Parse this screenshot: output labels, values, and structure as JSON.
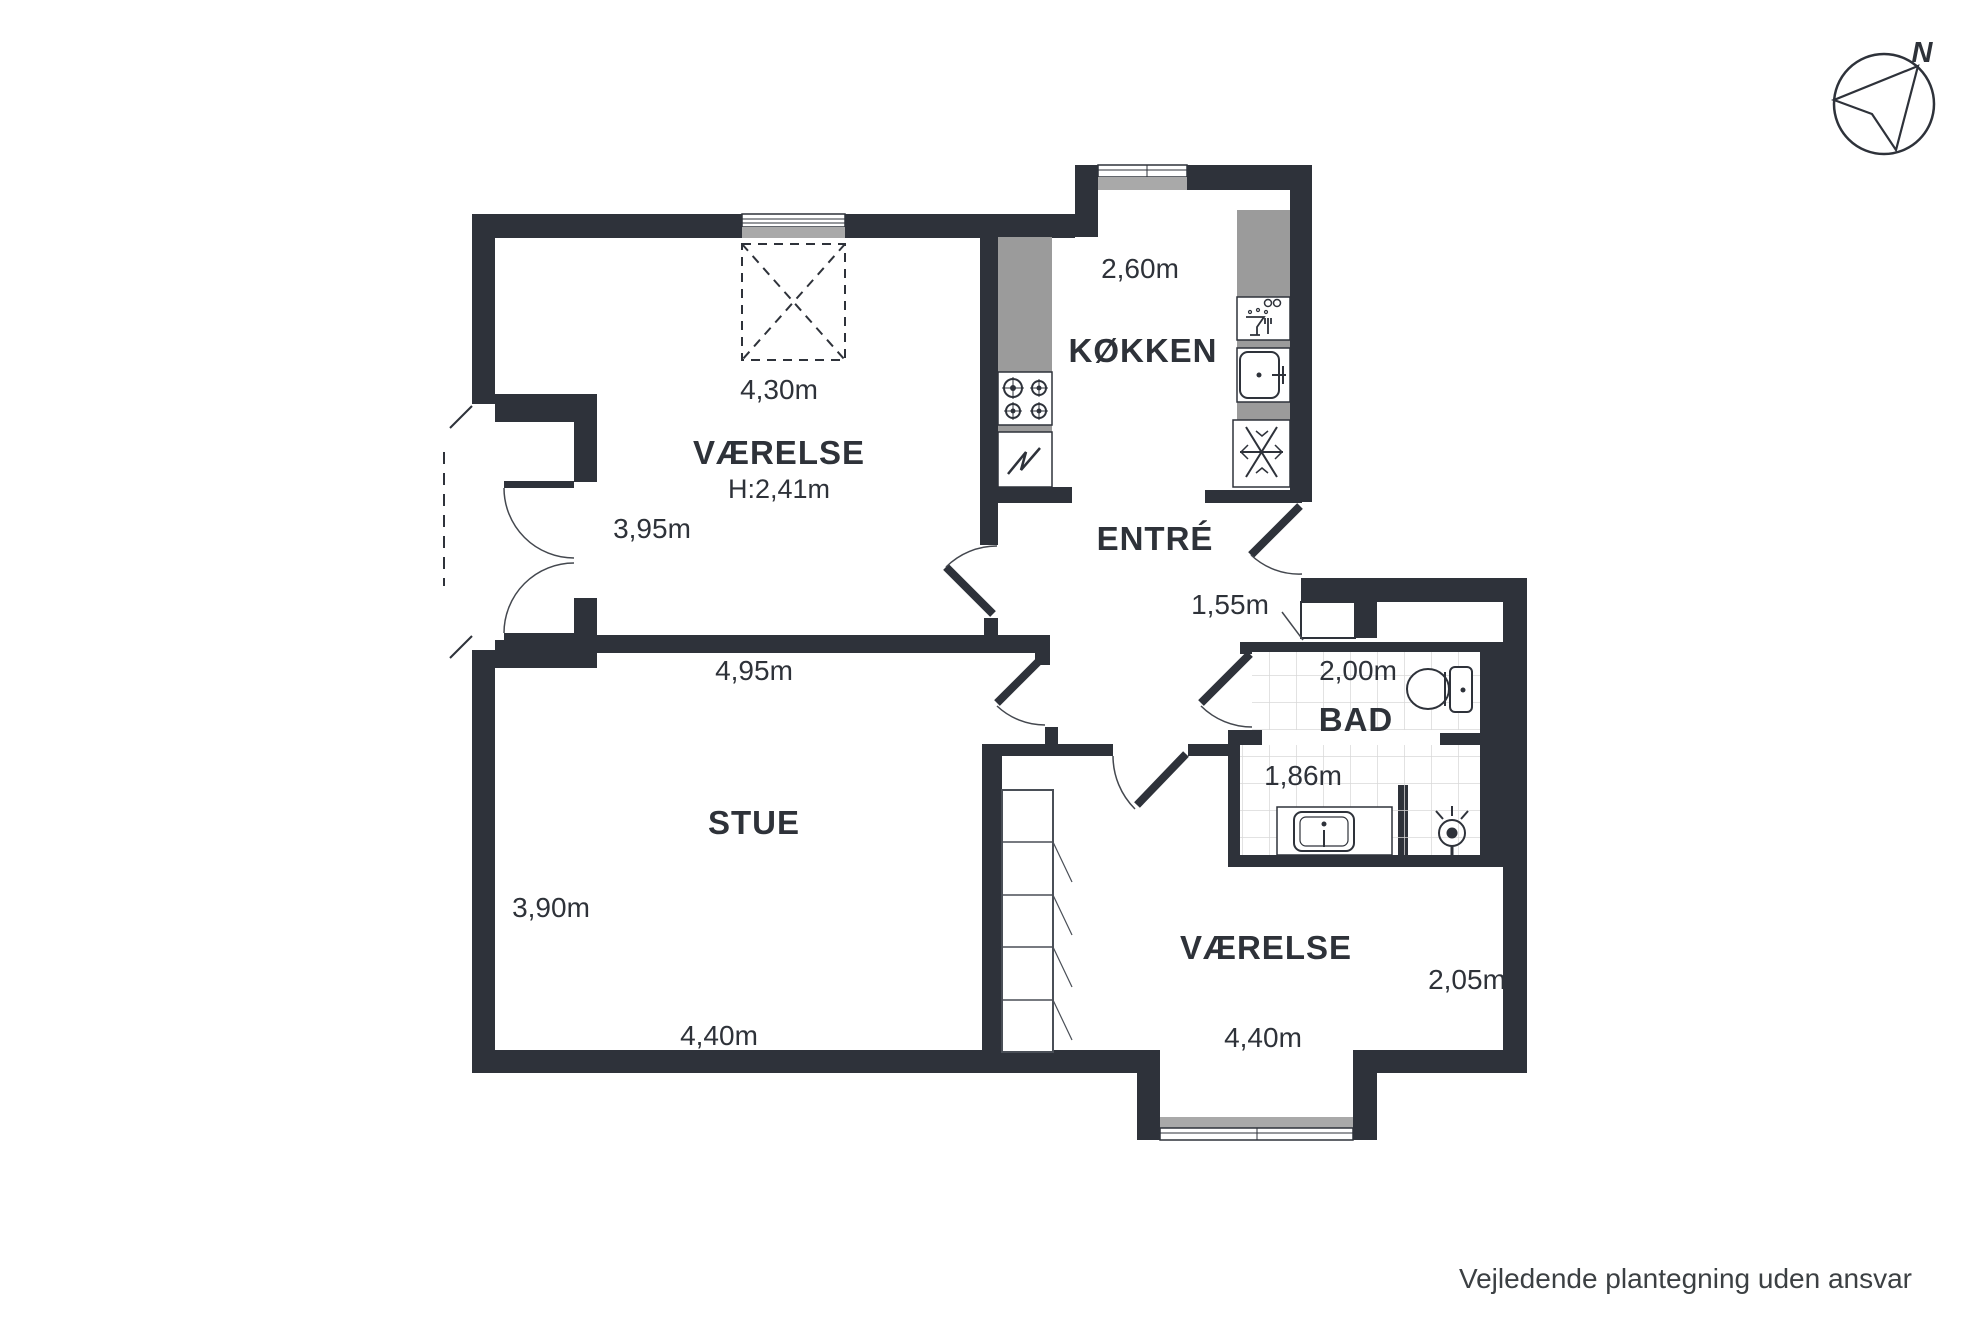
{
  "title": "Floor plan",
  "rooms": {
    "bedroom_top": {
      "name": "VÆRELSE",
      "ceiling_height": "H:2,41m",
      "width_top": "4,30m",
      "width_left": "3,95m"
    },
    "kitchen": {
      "name": "KØKKEN",
      "width": "2,60m"
    },
    "hall": {
      "name": "ENTRÉ",
      "width": "1,55m"
    },
    "bathroom": {
      "name": "BAD",
      "width_top": "2,00m",
      "width_bottom": "1,86m"
    },
    "living_room": {
      "name": "STUE",
      "width_top": "4,95m",
      "height_left": "3,90m",
      "width_bottom": "4,40m"
    },
    "bedroom_bottom": {
      "name": "VÆRELSE",
      "height_right": "2,05m",
      "width_bottom": "4,40m"
    }
  },
  "compass": {
    "north_label": "N"
  },
  "footer": {
    "disclaimer": "Vejledende plantegning uden ansvar"
  },
  "icons": [
    "compass-icon",
    "skylight-icon",
    "stove-icon",
    "oven-icon",
    "dishwasher-icon",
    "sink-icon",
    "freezer-icon",
    "toilet-icon",
    "vanity-sink-icon",
    "shower-icon",
    "closet-icon"
  ],
  "colors": {
    "wall": "#2e323a",
    "counter": "#9b9b9b",
    "window_sill": "#a9a9a9",
    "tile_line": "#d8d8d8",
    "label_text": "#2e3239",
    "footer_text": "#3c4043",
    "background": "#ffffff"
  }
}
